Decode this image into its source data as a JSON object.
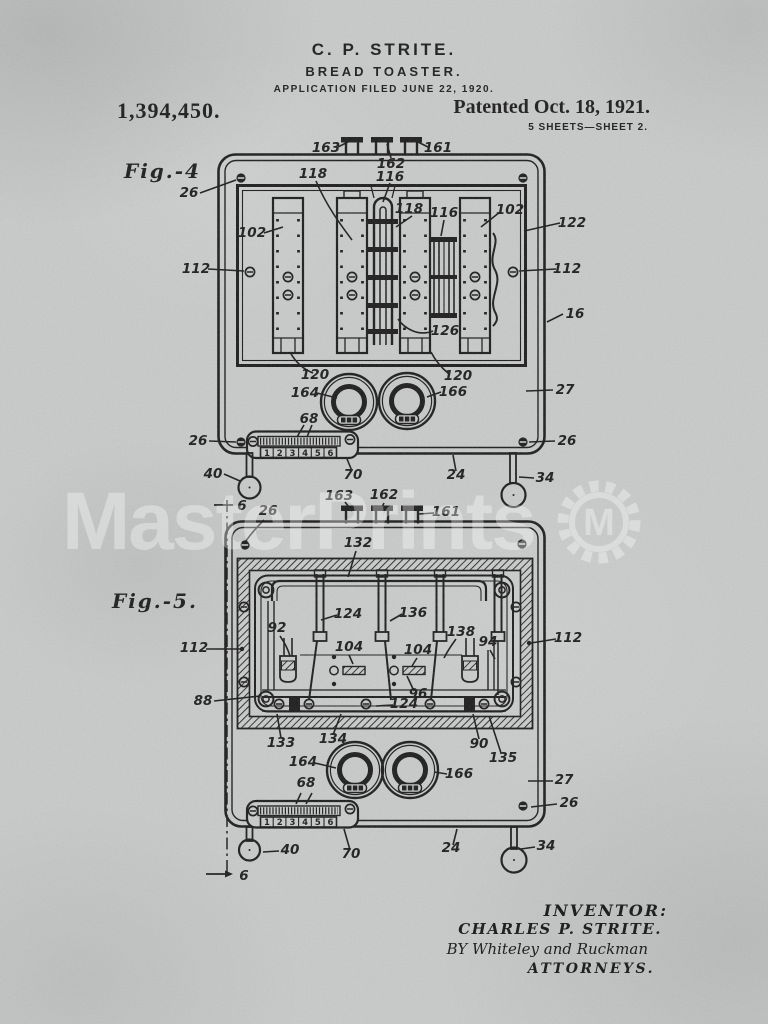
{
  "ink_color": "#1d1d1d",
  "paper_color": "#c9cbca",
  "header": {
    "inventor_name": "C. P. STRITE.",
    "invention_title": "BREAD TOASTER.",
    "application_line": "APPLICATION FILED JUNE 22, 1920.",
    "patent_number": "1,394,450.",
    "patent_date": "Patented Oct. 18, 1921.",
    "sheet_info": "5 SHEETS—SHEET 2."
  },
  "watermark": {
    "text": "MasterPrints",
    "logo_letter": "M"
  },
  "figure4": {
    "label": "Fig.-4",
    "scale_numbers": [
      "1",
      "2",
      "3",
      "4",
      "5",
      "6"
    ],
    "refs": [
      {
        "t": "163",
        "x": 326,
        "y": 152
      },
      {
        "t": "162",
        "x": 391,
        "y": 168
      },
      {
        "t": "116",
        "x": 390,
        "y": 181
      },
      {
        "t": "118",
        "x": 313,
        "y": 178
      },
      {
        "t": "161",
        "x": 438,
        "y": 152
      },
      {
        "t": "26",
        "x": 189,
        "y": 197
      },
      {
        "t": "102",
        "x": 252,
        "y": 237
      },
      {
        "t": "118",
        "x": 409,
        "y": 213
      },
      {
        "t": "116",
        "x": 444,
        "y": 217
      },
      {
        "t": "102",
        "x": 510,
        "y": 214
      },
      {
        "t": "122",
        "x": 572,
        "y": 227
      },
      {
        "t": "112",
        "x": 196,
        "y": 273
      },
      {
        "t": "112",
        "x": 567,
        "y": 273
      },
      {
        "t": "126",
        "x": 445,
        "y": 335
      },
      {
        "t": "16",
        "x": 575,
        "y": 318
      },
      {
        "t": "120",
        "x": 315,
        "y": 379
      },
      {
        "t": "120",
        "x": 458,
        "y": 380
      },
      {
        "t": "164",
        "x": 305,
        "y": 397
      },
      {
        "t": "166",
        "x": 453,
        "y": 396
      },
      {
        "t": "27",
        "x": 565,
        "y": 394
      },
      {
        "t": "68",
        "x": 309,
        "y": 423
      },
      {
        "t": "26",
        "x": 198,
        "y": 445
      },
      {
        "t": "26",
        "x": 567,
        "y": 445
      },
      {
        "t": "40",
        "x": 213,
        "y": 478
      },
      {
        "t": "70",
        "x": 353,
        "y": 479
      },
      {
        "t": "24",
        "x": 456,
        "y": 479
      },
      {
        "t": "34",
        "x": 545,
        "y": 482
      }
    ]
  },
  "figure5": {
    "label": "Fig.-5.",
    "scale_numbers": [
      "1",
      "2",
      "3",
      "4",
      "5",
      "6"
    ],
    "refs": [
      {
        "t": "163",
        "x": 339,
        "y": 500
      },
      {
        "t": "162",
        "x": 384,
        "y": 499
      },
      {
        "t": "161",
        "x": 446,
        "y": 516
      },
      {
        "t": "6",
        "x": 242,
        "y": 510
      },
      {
        "t": "26",
        "x": 268,
        "y": 515
      },
      {
        "t": "132",
        "x": 358,
        "y": 547
      },
      {
        "t": "124",
        "x": 348,
        "y": 618
      },
      {
        "t": "136",
        "x": 413,
        "y": 617
      },
      {
        "t": "92",
        "x": 277,
        "y": 632
      },
      {
        "t": "138",
        "x": 461,
        "y": 636
      },
      {
        "t": "94",
        "x": 488,
        "y": 646
      },
      {
        "t": "112",
        "x": 568,
        "y": 642
      },
      {
        "t": "112",
        "x": 194,
        "y": 652
      },
      {
        "t": "104",
        "x": 349,
        "y": 651
      },
      {
        "t": "104",
        "x": 418,
        "y": 654
      },
      {
        "t": "96",
        "x": 418,
        "y": 698
      },
      {
        "t": "124",
        "x": 404,
        "y": 708
      },
      {
        "t": "88",
        "x": 203,
        "y": 705
      },
      {
        "t": "133",
        "x": 281,
        "y": 747
      },
      {
        "t": "134",
        "x": 333,
        "y": 743
      },
      {
        "t": "90",
        "x": 479,
        "y": 748
      },
      {
        "t": "135",
        "x": 503,
        "y": 762
      },
      {
        "t": "164",
        "x": 303,
        "y": 766
      },
      {
        "t": "166",
        "x": 459,
        "y": 778
      },
      {
        "t": "27",
        "x": 564,
        "y": 784
      },
      {
        "t": "68",
        "x": 306,
        "y": 787
      },
      {
        "t": "26",
        "x": 569,
        "y": 807
      },
      {
        "t": "40",
        "x": 290,
        "y": 854
      },
      {
        "t": "70",
        "x": 351,
        "y": 858
      },
      {
        "t": "24",
        "x": 451,
        "y": 852
      },
      {
        "t": "34",
        "x": 546,
        "y": 850
      },
      {
        "t": "6",
        "x": 244,
        "y": 880
      }
    ]
  },
  "signature": {
    "inventor_heading": "INVENTOR:",
    "inventor_name": "CHARLES P. STRITE.",
    "by_line": "BY Whiteley and Ruckman",
    "attorneys": "ATTORNEYS."
  }
}
